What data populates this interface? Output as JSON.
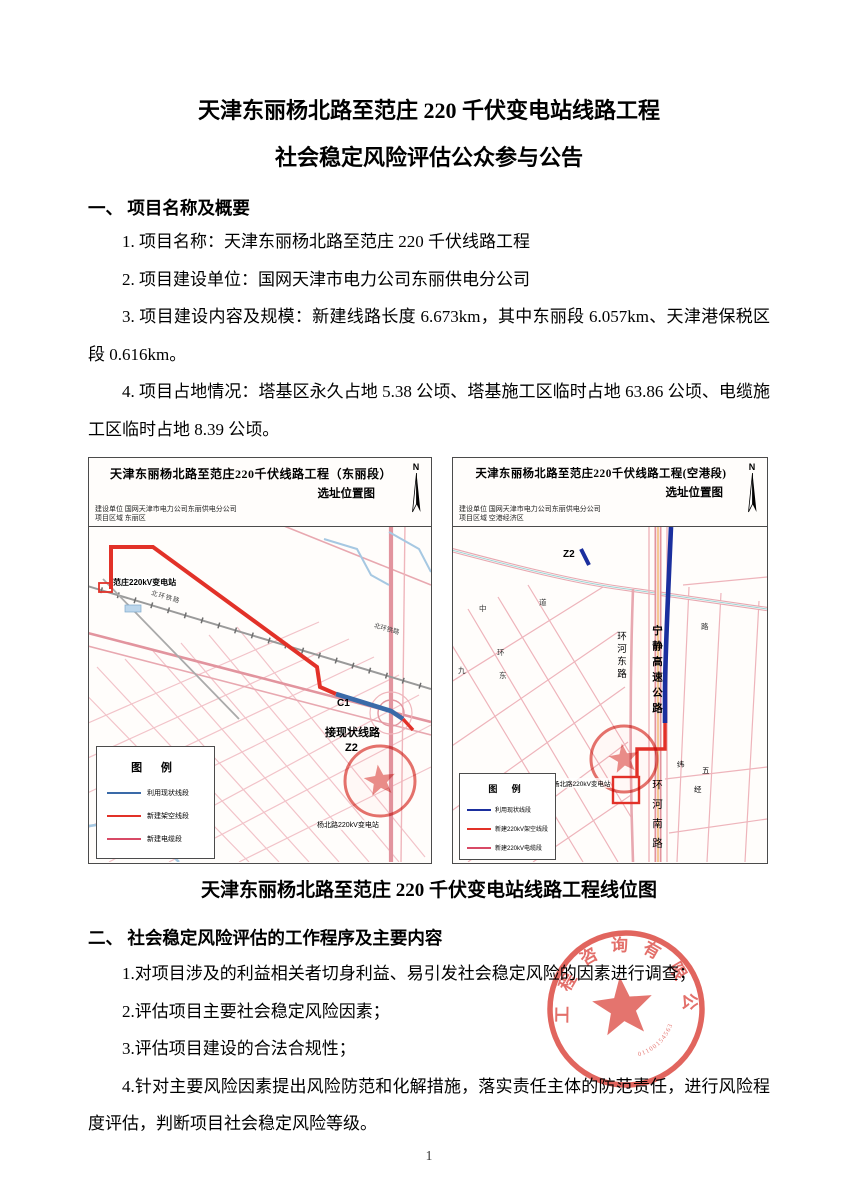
{
  "document": {
    "title_line1": "天津东丽杨北路至范庄 220 千伏变电站线路工程",
    "title_line2": "社会稳定风险评估公众参与公告",
    "page_number": "1"
  },
  "section1": {
    "heading": "一、 项目名称及概要",
    "items": [
      "1. 项目名称：天津东丽杨北路至范庄 220 千伏线路工程",
      "2. 项目建设单位：国网天津市电力公司东丽供电分公司",
      "3. 项目建设内容及规模：新建线路长度 6.673km，其中东丽段 6.057km、天津港保税区段 0.616km。",
      "4. 项目占地情况：塔基区永久占地 5.38 公顷、塔基施工区临时占地 63.86 公顷、电缆施工区临时占地 8.39 公顷。"
    ]
  },
  "section2": {
    "heading": "二、 社会稳定风险评估的工作程序及主要内容",
    "items": [
      "1.对项目涉及的利益相关者切身利益、易引发社会稳定风险的因素进行调查；",
      "2.评估项目主要社会稳定风险因素；",
      "3.评估项目建设的合法合规性；",
      "4.针对主要风险因素提出风险防范和化解措施，落实责任主体的防范责任，进行风险程度评估，判断项目社会稳定风险等级。"
    ]
  },
  "figure": {
    "caption": "天津东丽杨北路至范庄 220 千伏变电站线路工程线位图",
    "left_map": {
      "title": "天津东丽杨北路至范庄220千伏线路工程（东丽段）",
      "subtitle": "选址位置图",
      "builder": "建设单位 国网天津市电力公司东丽供电分公司",
      "region": "项目区域 东丽区",
      "north_label": "N",
      "legend_title": "图 例",
      "legend": [
        {
          "label": "利用现状线段",
          "color": "#3a6aa8"
        },
        {
          "label": "新建架空线段",
          "color": "#e23128"
        },
        {
          "label": "新建电缆段",
          "color": "#d84a66"
        }
      ],
      "labels": {
        "substation_start": "范庄220kV变电站",
        "railway_a": "北环铁路",
        "railway_b": "北环铁路",
        "connect_existing": "接现状线路",
        "point_c1": "C1",
        "point_z2": "Z2",
        "substation_end": "杨北路220kV变电站"
      }
    },
    "right_map": {
      "title": "天津东丽杨北路至范庄220千伏线路工程(空港段)",
      "subtitle": "选址位置图",
      "builder": "建设单位 国网天津市电力公司东丽供电分公司",
      "region": "项目区域 空港经济区",
      "north_label": "N",
      "legend_title": "图 例",
      "legend": [
        {
          "label": "利用现状线段",
          "color": "#1b2f9e"
        },
        {
          "label": "新建220kV架空线段",
          "color": "#e23128"
        },
        {
          "label": "新建220kV电缆段",
          "color": "#d84a66"
        }
      ],
      "labels": {
        "point_z2": "Z2",
        "ring_east_road": "环河东路",
        "highway": "宁静高速公路",
        "ring_south_road": "环河南路",
        "substation_end": "杨北路220kV变电站",
        "wei": "纬",
        "five": "五",
        "jing": "经",
        "road_chars": [
          "中",
          "道",
          "九",
          "环",
          "东",
          "路"
        ]
      }
    }
  },
  "seal": {
    "ring_text": "工程咨询有限公司",
    "serial": "01100154563",
    "color": "#dd4f48"
  },
  "colors": {
    "route_new_overhead": "#e23128",
    "route_existing_left": "#3a6aa8",
    "route_existing_right": "#1b2f9e"
  }
}
